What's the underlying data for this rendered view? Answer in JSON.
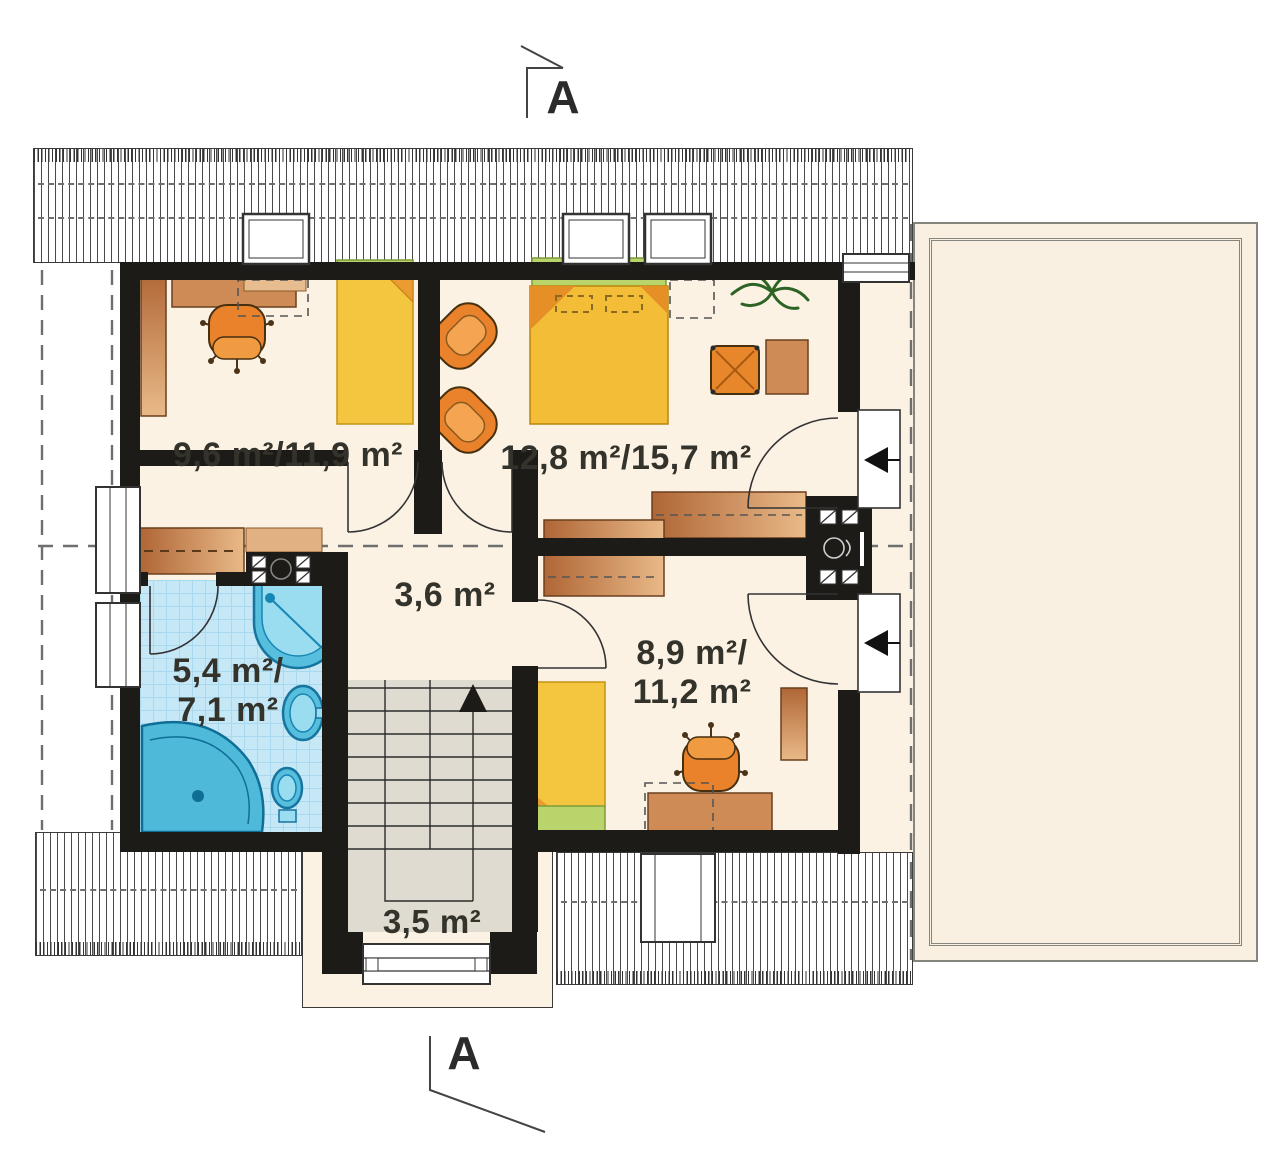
{
  "section_markers": {
    "top_label": "A",
    "bottom_label": "A"
  },
  "rooms": {
    "bedroom_left": {
      "area": "9,6 m²/11,9 m²"
    },
    "bedroom_middle": {
      "area": "12,8 m²/15,7 m²"
    },
    "hall": {
      "area": "3,6 m²"
    },
    "bathroom": {
      "area_line1": "5,4 m²/",
      "area_line2": "7,1 m²"
    },
    "bedroom_right": {
      "area_line1": "8,9 m²/",
      "area_line2": "11,2 m²"
    },
    "staircase": {
      "area": "3,5 m²"
    }
  },
  "palette": {
    "wall": "#1d1b18",
    "floor": "#fbf2e4",
    "bathroom_floor": "#c6e7f6",
    "stair_floor": "#dfdbd1",
    "terrace": "#faf0e1",
    "wood": "#cf8b55",
    "furniture_orange": "#e9822a",
    "bed_yellow": "#f4c53e",
    "headboard_green": "#b9d46a",
    "fixture_blue": "#57bedd"
  }
}
